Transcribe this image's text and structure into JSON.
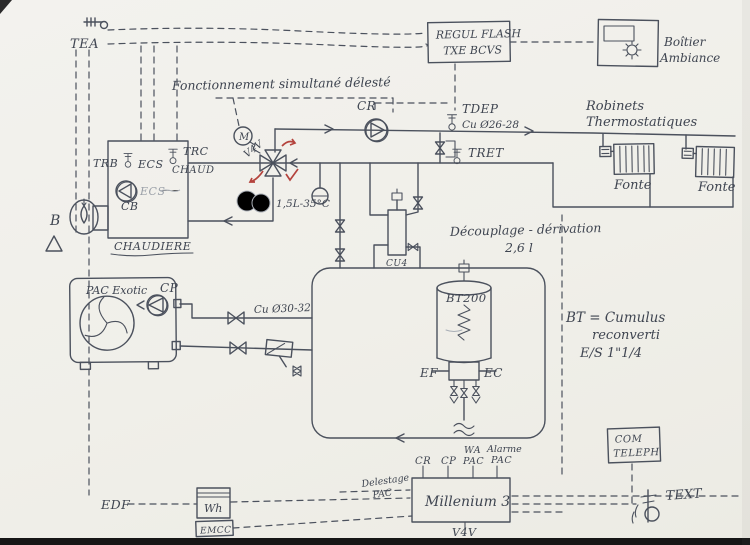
{
  "labels": {
    "tea": "TEA",
    "regul": {
      "line1": "REGUL FLASH",
      "line2": "TXE BCVS"
    },
    "boitier": {
      "line1": "Boîtier",
      "line2": "Ambiance"
    },
    "fonctionnement": "Fonctionnement simultané délesté",
    "cr": "CR",
    "tdep": "TDEP",
    "cu2628": "Cu Ø26-28",
    "tret": "TRET",
    "robinets": {
      "line1": "Robinets",
      "line2": "Thermostatiques"
    },
    "fonte1": "Fonte",
    "fonte2": "Fonte",
    "boiler": {
      "trb": "TRB",
      "ecs_top": "ECS",
      "trc": "TRC",
      "chaud": "CHAUD",
      "ecs_pump": "ECS",
      "cb": "CB",
      "name": "CHAUDIERE"
    },
    "burner": "B",
    "v4v": {
      "motor": "M",
      "name": "V4V",
      "setpoint": "1,5L-35°C"
    },
    "decouplage": {
      "line1": "Découplage - dérivation",
      "line2": "2,6 l",
      "pipe": "CU4"
    },
    "pac": {
      "name": "PAC Exotic",
      "cp": "CP"
    },
    "cu3032": "Cu Ø30-32",
    "bt": {
      "tank": "BT200",
      "ef": "EF",
      "ec": "EC",
      "note1": "BT = Cumulus",
      "note2": "reconverti",
      "note3": "E/S 1\"1/4"
    },
    "com": {
      "line1": "COM",
      "line2": "TELEPH"
    },
    "text_sensor": "TEXT",
    "millenium": {
      "name": "Millenium 3",
      "in_cr": "CR",
      "in_cp": "CP",
      "in_wa1": "WA",
      "in_wa2": "PAC",
      "in_al1": "Alarme",
      "in_al2": "PAC",
      "out": "V4V",
      "delestage1": "Delestage",
      "delestage2": "PAC"
    },
    "edf": "EDF",
    "meter": {
      "wh": "Wh",
      "emcc": "EMCC"
    }
  },
  "colors": {
    "ink": "#4b515d",
    "red": "#b4433d",
    "paper": "#f1f0ea",
    "pencil_light": "#a9aeb6"
  }
}
